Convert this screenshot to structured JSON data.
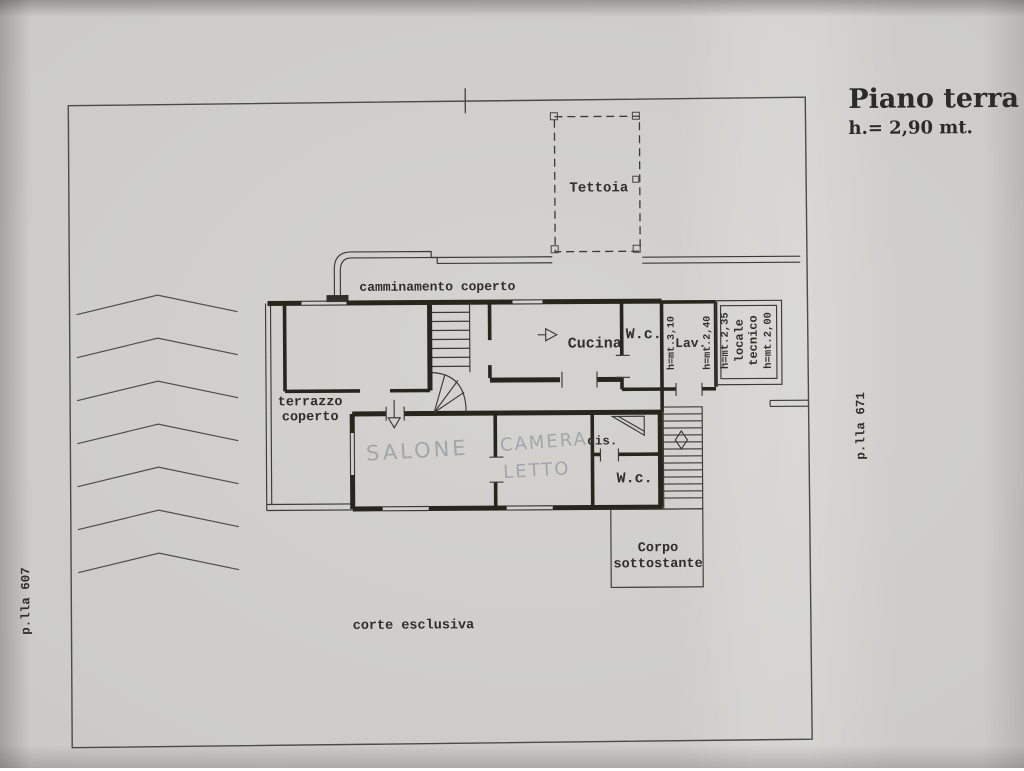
{
  "document": {
    "title": "Piano terra",
    "subtitle": "h.= 2,90 mt."
  },
  "parcels": {
    "left": "p.lla 607",
    "right": "p.lla 671"
  },
  "site": {
    "tettoia": "Tettoia",
    "camminamento": "camminamento coperto",
    "terrazzo_line1": "terrazzo",
    "terrazzo_line2": "coperto",
    "corte": "corte esclusiva",
    "corpo_line1": "Corpo",
    "corpo_line2": "sottostante"
  },
  "rooms": {
    "cucina": "Cucina",
    "wc_top": "W.c.",
    "lav": "Lav.",
    "locale_line1": "locale",
    "locale_line2": "tecnico",
    "dis": "dis.",
    "wc_bottom": "W.c.",
    "salone": "SALONE",
    "camera_line1": "CAMERA",
    "camera_line2": "LETTO"
  },
  "heights": {
    "lav": "h=mt.3,10",
    "wc_top": "h=mt.2,40",
    "locale_left": "h=mt.2,35",
    "locale_right": "h=mt.2,00"
  },
  "colors": {
    "paper": "#cdccc9",
    "ink": "#35352f",
    "pencil": "#9fa2a6"
  }
}
